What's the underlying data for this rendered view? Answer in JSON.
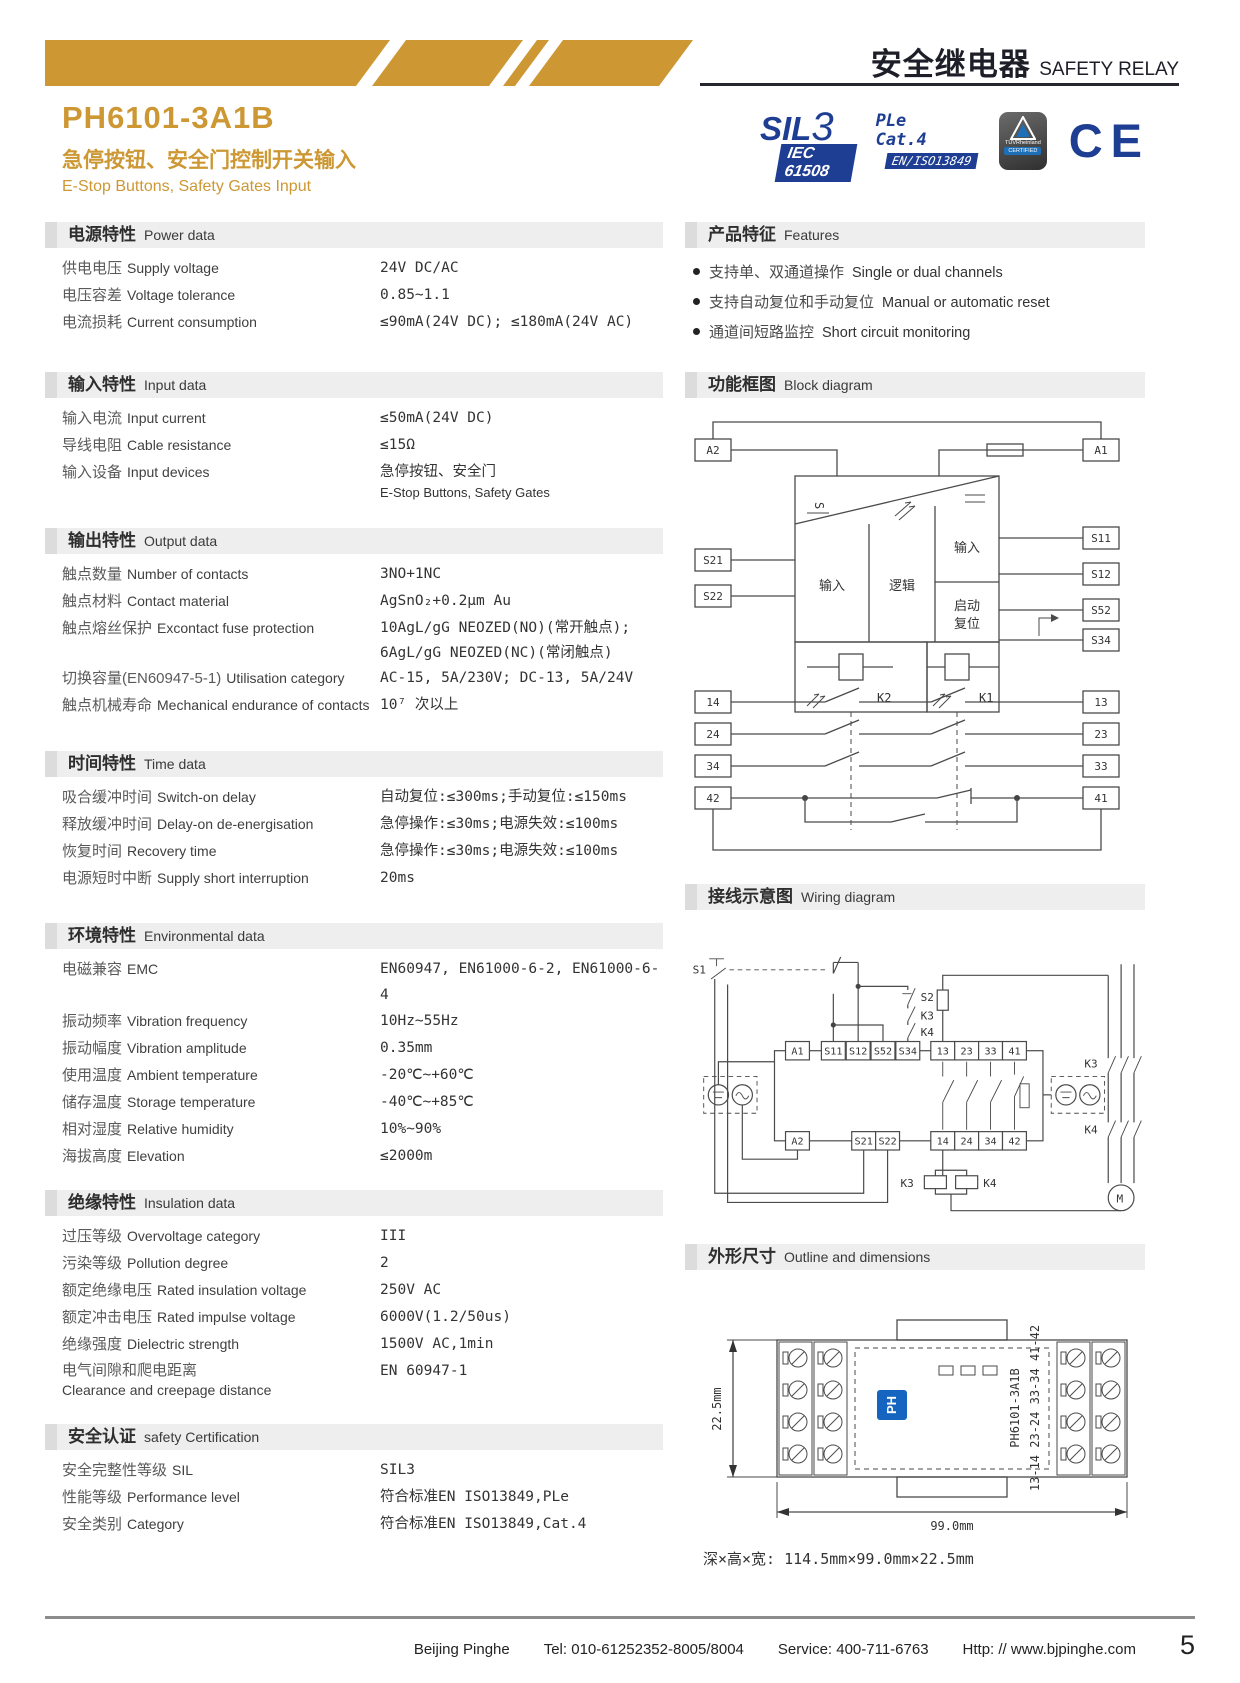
{
  "header": {
    "banner_cn": "安全继电器",
    "banner_en": "SAFETY RELAY",
    "model": "PH6101-3A1B",
    "subtitle_cn": "急停按钮、安全门控制开关输入",
    "subtitle_en": "E-Stop Buttons, Safety Gates Input"
  },
  "badges": {
    "sil_prefix": "SIL",
    "sil_num": "3",
    "sil_std": "IEC 61508",
    "pl_line1": "PLe",
    "pl_line2": "Cat.4",
    "pl_std": "EN/ISO13849",
    "tuv_name": "TÜVRheinland",
    "tuv_sub": "CERTIFIED",
    "ce": "CE"
  },
  "colors": {
    "gold": "#cd9834",
    "navy": "#1d3e92"
  },
  "power": {
    "title_cn": "电源特性",
    "title_en": "Power data",
    "rows": [
      {
        "cn": "供电电压",
        "en": "Supply voltage",
        "value": "24V DC/AC"
      },
      {
        "cn": "电压容差",
        "en": "Voltage tolerance",
        "value": "0.85~1.1"
      },
      {
        "cn": "电流损耗",
        "en": "Current consumption",
        "value": "≤90mA(24V DC); ≤180mA(24V AC)"
      }
    ]
  },
  "input": {
    "title_cn": "输入特性",
    "title_en": "Input data",
    "rows": [
      {
        "cn": "输入电流",
        "en": "Input current",
        "value": "≤50mA(24V DC)"
      },
      {
        "cn": "导线电阻",
        "en": "Cable resistance",
        "value": "≤15Ω"
      },
      {
        "cn": "输入设备",
        "en": "Input devices",
        "value": "急停按钮、安全门",
        "value2": "E-Stop Buttons, Safety Gates"
      }
    ]
  },
  "output": {
    "title_cn": "输出特性",
    "title_en": "Output data",
    "rows": [
      {
        "cn": "触点数量",
        "en": "Number of contacts",
        "value": "3NO+1NC"
      },
      {
        "cn": "触点材料",
        "en": "Contact material",
        "value": "AgSnO₂+0.2μm Au"
      },
      {
        "cn": "触点熔丝保护",
        "en": "Excontact fuse protection",
        "value": "10AgL/gG NEOZED(NO)(常开触点);",
        "value2": "6AgL/gG NEOZED(NC)(常闭触点)"
      },
      {
        "cn": "切换容量(EN60947-5-1)",
        "en": "Utilisation category",
        "value": "AC-15, 5A/230V; DC-13, 5A/24V"
      },
      {
        "cn": "触点机械寿命",
        "en": "Mechanical endurance of contacts",
        "value": "10⁷ 次以上"
      }
    ]
  },
  "time": {
    "title_cn": "时间特性",
    "title_en": "Time data",
    "rows": [
      {
        "cn": "吸合缓冲时间",
        "en": "Switch-on delay",
        "value": "自动复位:≤300ms;手动复位:≤150ms"
      },
      {
        "cn": "释放缓冲时间",
        "en": "Delay-on de-energisation",
        "value": "急停操作:≤30ms;电源失效:≤100ms"
      },
      {
        "cn": "恢复时间",
        "en": "Recovery time",
        "value": "急停操作:≤30ms;电源失效:≤100ms"
      },
      {
        "cn": "电源短时中断",
        "en": "Supply short interruption",
        "value": "20ms"
      }
    ]
  },
  "env": {
    "title_cn": "环境特性",
    "title_en": "Environmental data",
    "rows": [
      {
        "cn": "电磁兼容",
        "en": "EMC",
        "value": "EN60947, EN61000-6-2, EN61000-6-4"
      },
      {
        "cn": "振动频率",
        "en": "Vibration frequency",
        "value": "10Hz~55Hz"
      },
      {
        "cn": "振动幅度",
        "en": "Vibration amplitude",
        "value": "0.35mm"
      },
      {
        "cn": "使用温度",
        "en": "Ambient temperature",
        "value": "-20℃~+60℃"
      },
      {
        "cn": "储存温度",
        "en": "Storage temperature",
        "value": "-40℃~+85℃"
      },
      {
        "cn": "相对湿度",
        "en": "Relative humidity",
        "value": "10%~90%"
      },
      {
        "cn": "海拔高度",
        "en": "Elevation",
        "value": "≤2000m"
      }
    ]
  },
  "insulation": {
    "title_cn": "绝缘特性",
    "title_en": "Insulation data",
    "rows": [
      {
        "cn": "过压等级",
        "en": "Overvoltage category",
        "value": "III"
      },
      {
        "cn": "污染等级",
        "en": "Pollution degree",
        "value": "2"
      },
      {
        "cn": "额定绝缘电压",
        "en": "Rated insulation voltage",
        "value": "250V AC"
      },
      {
        "cn": "额定冲击电压",
        "en": "Rated impulse voltage",
        "value": "6000V(1.2/50us)"
      },
      {
        "cn": "绝缘强度",
        "en": "Dielectric strength",
        "value": "1500V AC,1min"
      },
      {
        "cn": "电气间隙和爬电距离",
        "en": "Clearance and creepage distance",
        "value": "EN 60947-1"
      }
    ]
  },
  "cert": {
    "title_cn": "安全认证",
    "title_en": "safety Certification",
    "rows": [
      {
        "cn": "安全完整性等级",
        "en": "SIL",
        "value": "SIL3"
      },
      {
        "cn": "性能等级",
        "en": "Performance level",
        "value": "符合标准EN ISO13849,PLe"
      },
      {
        "cn": "安全类别",
        "en": "Category",
        "value": "符合标准EN ISO13849,Cat.4"
      }
    ]
  },
  "features": {
    "title_cn": "产品特征",
    "title_en": "Features",
    "items": [
      {
        "cn": "支持单、双通道操作",
        "en": "Single or dual channels"
      },
      {
        "cn": "支持自动复位和手动复位",
        "en": "Manual or automatic reset"
      },
      {
        "cn": "通道间短路监控",
        "en": "Short circuit monitoring"
      }
    ]
  },
  "block": {
    "title_cn": "功能框图",
    "title_en": "Block diagram",
    "left_terminals": [
      "A2",
      "S21",
      "S22",
      "14",
      "24",
      "34",
      "42"
    ],
    "right_terminals": [
      "A1",
      "S11",
      "S12",
      "S52",
      "S34",
      "13",
      "23",
      "33",
      "41"
    ],
    "labels": {
      "ac": "S",
      "input1": "输入",
      "logic": "逻辑",
      "input2": "输入",
      "reset1": "启动",
      "reset2": "复位",
      "k2": "K2",
      "k1": "K1"
    }
  },
  "wiring": {
    "title_cn": "接线示意图",
    "title_en": "Wiring diagram",
    "labels": {
      "s1": "S1",
      "s2": "S2",
      "k3": "K3",
      "k4": "K4",
      "k3c": "K3",
      "k4c": "K4",
      "k3r": "K3",
      "k4r": "K4",
      "motor": "M"
    },
    "top_terminals": [
      "A1",
      "S11",
      "S12",
      "S52",
      "S34",
      "13",
      "23",
      "33",
      "41"
    ],
    "bottom_terminals": [
      "A2",
      "S21",
      "S22",
      "14",
      "24",
      "34",
      "42"
    ]
  },
  "outline": {
    "title_cn": "外形尺寸",
    "title_en": "Outline and dimensions",
    "height_dim": "22.5mm",
    "width_dim": "99.0mm",
    "model_vertical": "PH6101-3A1B",
    "terminal_map": "13-14  23-24  33-34  41-42",
    "logo": "PH",
    "note": "深×高×宽: 114.5mm×99.0mm×22.5mm"
  },
  "footer": {
    "company": "Beijing Pinghe",
    "tel": "Tel: 010-61252352-8005/8004",
    "service": "Service: 400-711-6763",
    "web": "Http: // www.bjpinghe.com",
    "page": "5"
  }
}
